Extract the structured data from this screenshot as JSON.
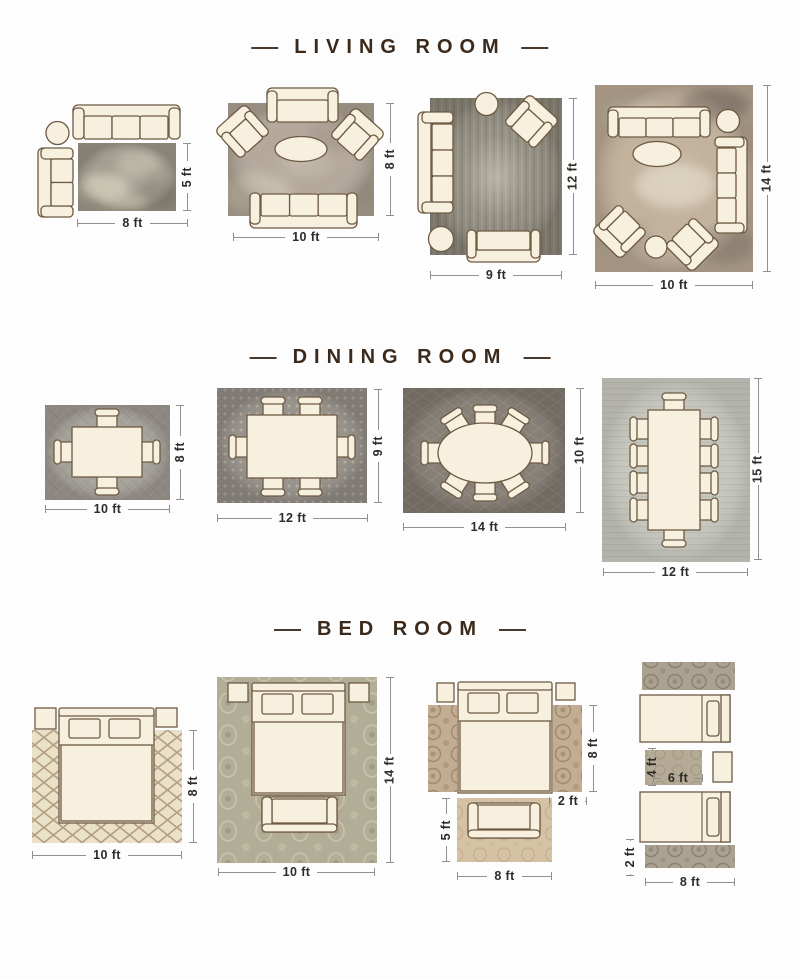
{
  "page": {
    "background": "#fdfdfd"
  },
  "styles": {
    "title_color": "#3b2a1b",
    "dimension_text_color": "#2e2c28",
    "dimension_line_color": "#8f8f8f",
    "furniture_fill": "#f8f0df",
    "furniture_outline": "#6d5a43"
  },
  "sections": [
    {
      "id": "living-room",
      "title": "LIVING ROOM",
      "layouts": [
        {
          "id": "living-8x5",
          "width_label": "8 ft",
          "height_label": "5 ft",
          "furniture": [
            "sofa",
            "side-table",
            "loveseat",
            "rug"
          ]
        },
        {
          "id": "living-10x8",
          "width_label": "10 ft",
          "height_label": "8 ft",
          "furniture": [
            "loveseat",
            "accent-chair",
            "accent-chair",
            "coffee-table",
            "sofa",
            "rug"
          ]
        },
        {
          "id": "living-9x12",
          "width_label": "9 ft",
          "height_label": "12 ft",
          "furniture": [
            "side-table",
            "accent-chair",
            "sofa",
            "ottoman",
            "loveseat",
            "rug"
          ]
        },
        {
          "id": "living-10x14",
          "width_label": "10 ft",
          "height_label": "14 ft",
          "furniture": [
            "sofa",
            "side-table",
            "sofa",
            "coffee-table",
            "accent-chair",
            "ottoman",
            "accent-chair",
            "rug"
          ]
        }
      ]
    },
    {
      "id": "dining-room",
      "title": "DINING ROOM",
      "layouts": [
        {
          "id": "dining-10x8",
          "width_label": "10 ft",
          "height_label": "8 ft",
          "furniture": [
            "dining-table",
            "4 dining-chairs",
            "rug"
          ]
        },
        {
          "id": "dining-12x9",
          "width_label": "12 ft",
          "height_label": "9 ft",
          "furniture": [
            "dining-table",
            "6 dining-chairs",
            "rug"
          ]
        },
        {
          "id": "dining-14x10",
          "width_label": "14 ft",
          "height_label": "10 ft",
          "furniture": [
            "oval-dining-table",
            "8 dining-chairs",
            "rug"
          ]
        },
        {
          "id": "dining-12x15",
          "width_label": "12 ft",
          "height_label": "15 ft",
          "furniture": [
            "dining-table",
            "10 dining-chairs",
            "rug"
          ]
        }
      ]
    },
    {
      "id": "bed-room",
      "title": "BED ROOM",
      "layouts": [
        {
          "id": "bed-10x8",
          "width_label": "10 ft",
          "height_label": "8 ft",
          "furniture": [
            "nightstand",
            "bed",
            "nightstand",
            "rug"
          ]
        },
        {
          "id": "bed-10x14",
          "width_label": "10 ft",
          "height_label": "14 ft",
          "furniture": [
            "nightstand",
            "bed",
            "nightstand",
            "bench",
            "rug"
          ]
        },
        {
          "id": "bed-runners",
          "runner_length_label": "8 ft",
          "runner_width_label": "2 ft",
          "foot_rug_height_label": "5 ft",
          "foot_rug_width_label": "8 ft",
          "furniture": [
            "nightstand",
            "bed",
            "nightstand",
            "runner-rug",
            "runner-rug",
            "bench",
            "accent-rug"
          ]
        },
        {
          "id": "bed-twin-runners",
          "accent_rug_height_label": "4 ft",
          "accent_rug_width_label": "6 ft",
          "runner_width_label": "2 ft",
          "runner_length_label": "8 ft",
          "furniture": [
            "runner-rug",
            "twin-bed",
            "accent-rug",
            "nightstand",
            "twin-bed",
            "runner-rug"
          ]
        }
      ]
    }
  ]
}
